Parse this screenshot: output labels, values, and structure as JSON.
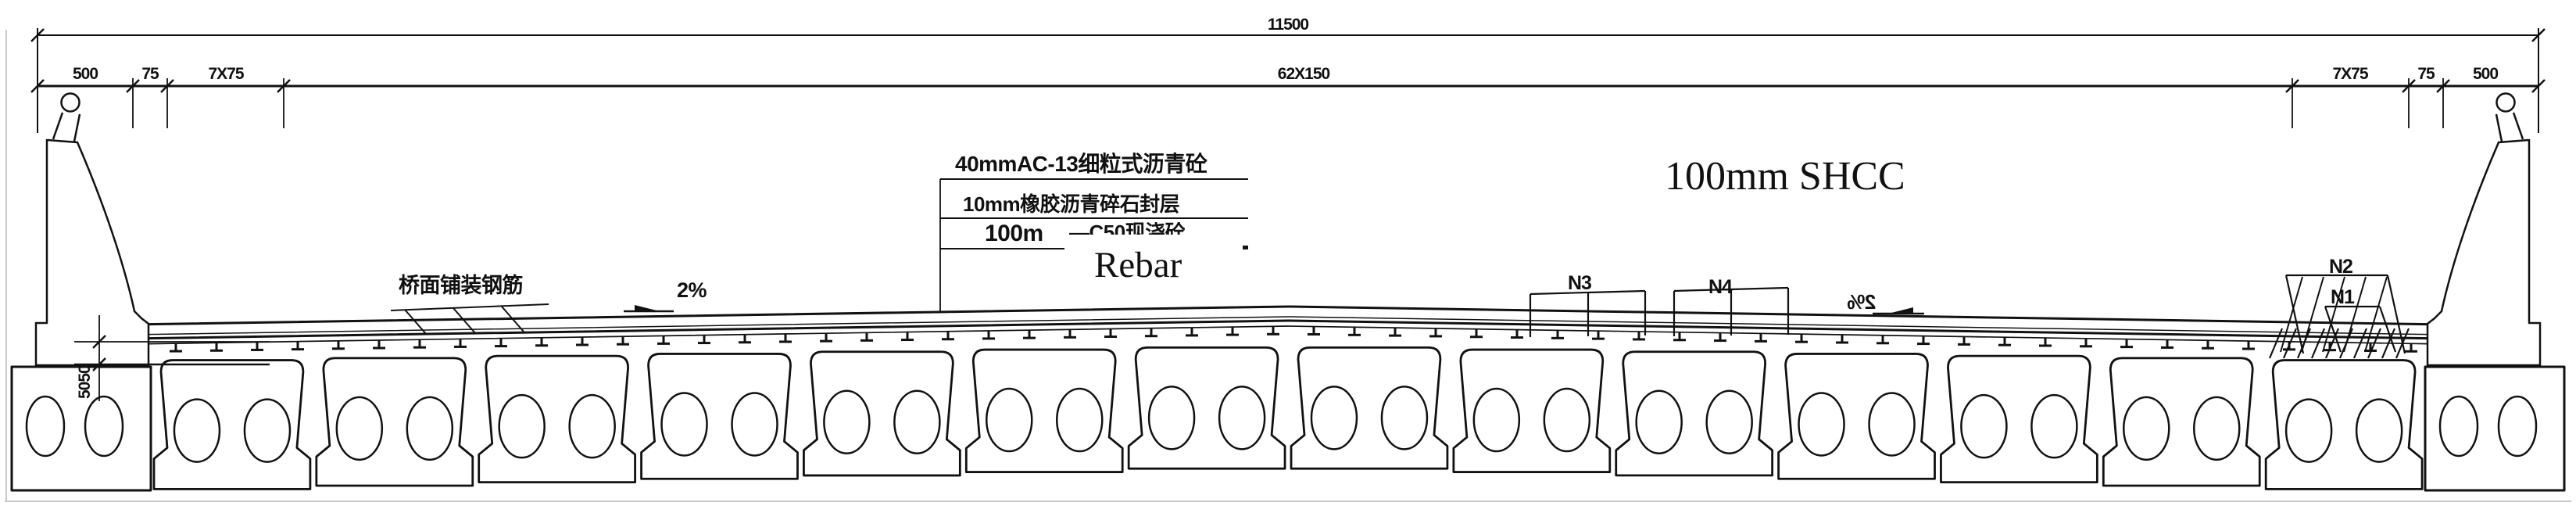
{
  "figure_title": "bridge-deck-cross-section",
  "dims": {
    "total": "11500",
    "center_spacing": "62X150",
    "left": [
      "500",
      "75",
      "7X75"
    ],
    "right": [
      "7X75",
      "75",
      "500"
    ],
    "edge_vertical": "5050"
  },
  "layers": {
    "line1": "40mmAC-13细粒式沥青砼",
    "line2": "10mm橡胶沥青碎石封层",
    "line3": "100m",
    "line3_hidden": "—C50现浇砼"
  },
  "labels": {
    "rebar": "Rebar",
    "shcc": "100mm SHCC",
    "deck_rebar": "桥面铺装钢筋",
    "slope_left": "2%",
    "slope_right": "2%",
    "n1": "N1",
    "n2": "N2",
    "n3": "N3",
    "n4": "N4"
  },
  "structure": {
    "interior_beam_count": 14,
    "edge_beam_count": 2,
    "voids_per_beam": 2,
    "deck_tick_spacing": 52
  },
  "colors": {
    "ink": "#111111",
    "border_gray": "#c9c9c9",
    "background": "#ffffff"
  }
}
